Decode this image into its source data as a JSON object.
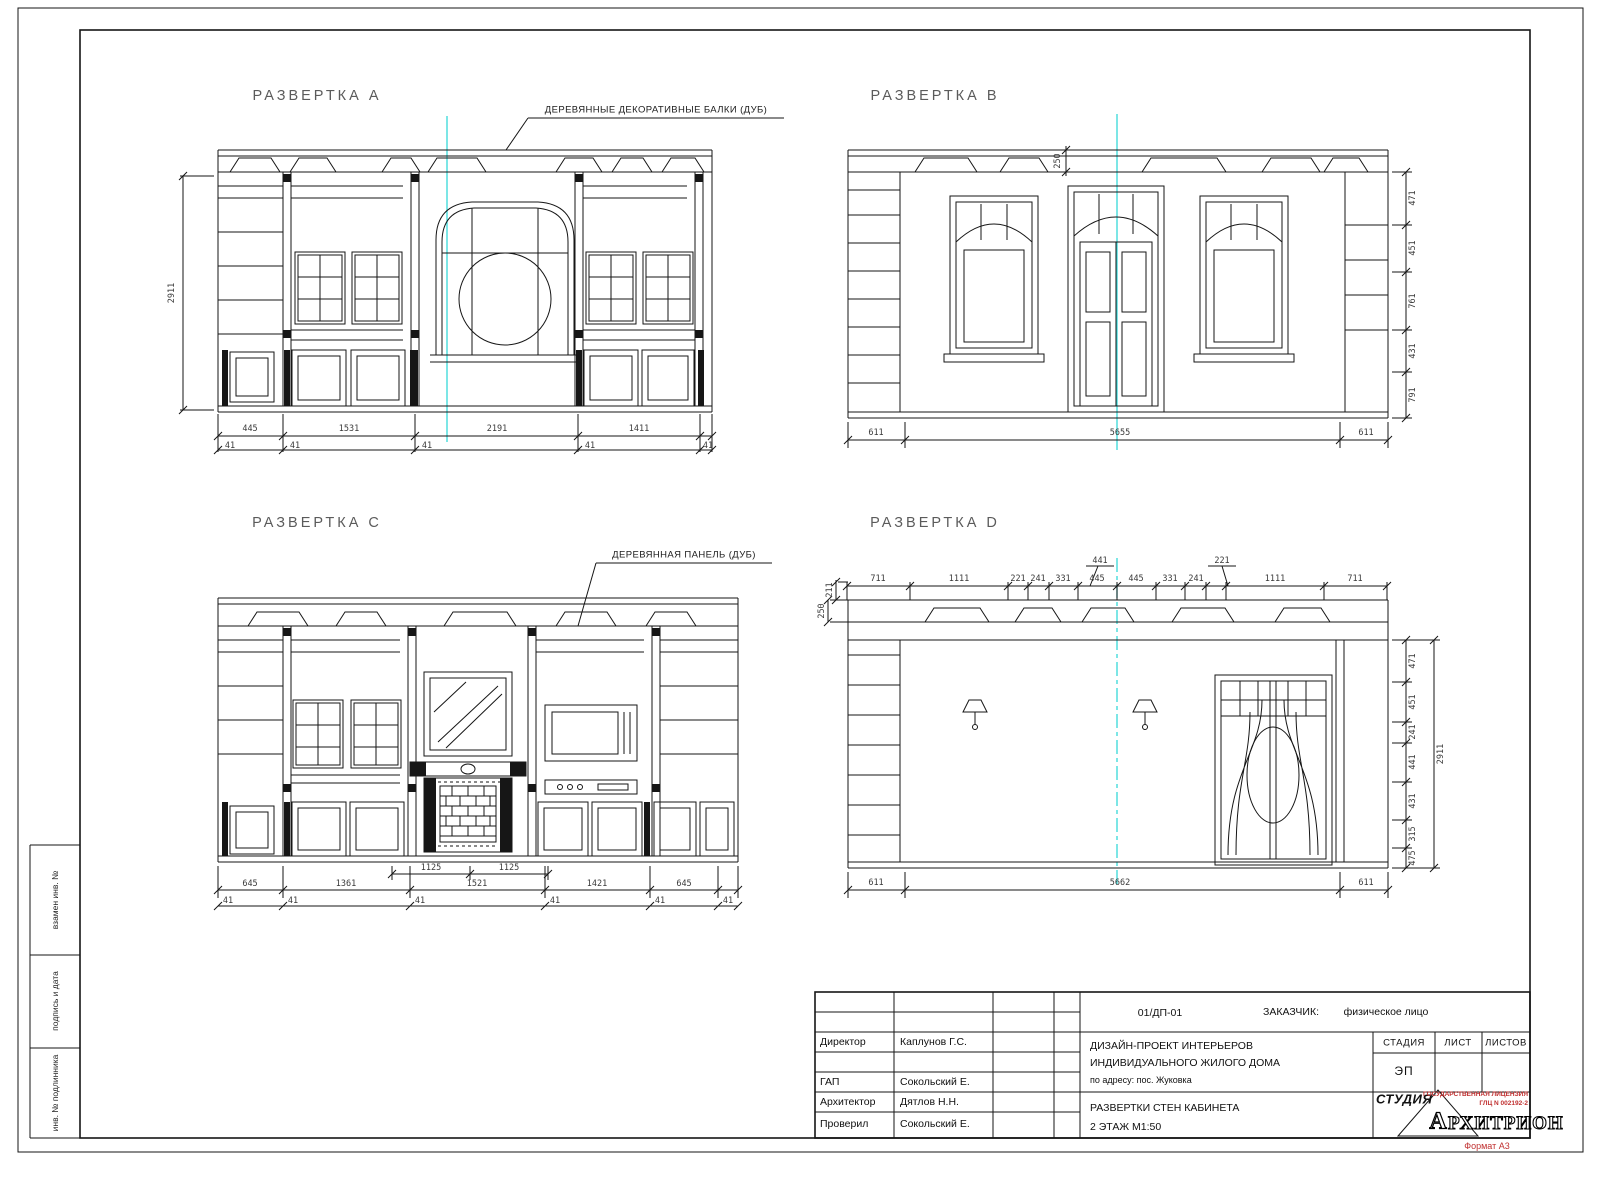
{
  "palette": {
    "ink": "#161616",
    "dim": "#3a3a3a",
    "title": "#5b5b5b",
    "cyan": "#35d8d8",
    "red": "#c03030"
  },
  "elevations": {
    "a": {
      "title": "РАЗВЕРТКА  A",
      "callout": "ДЕРЕВЯННЫЕ ДЕКОРАТИВНЫЕ БАЛКИ (ДУБ)"
    },
    "b": {
      "title": "РАЗВЕРТКА  B"
    },
    "c": {
      "title": "РАЗВЕРТКА  C",
      "callout": "ДЕРЕВЯННАЯ ПАНЕЛЬ (ДУБ)"
    },
    "d": {
      "title": "РАЗВЕРТКА  D"
    }
  },
  "dim_labels": {
    "a": [
      {
        "t": "2911",
        "x": 172,
        "y": 293,
        "r": -90
      },
      {
        "t": "445",
        "x": 250,
        "y": 429
      },
      {
        "t": "1531",
        "x": 349,
        "y": 429
      },
      {
        "t": "2191",
        "x": 497,
        "y": 429
      },
      {
        "t": "1411",
        "x": 639,
        "y": 429
      },
      {
        "t": "41",
        "x": 230,
        "y": 446
      },
      {
        "t": "41",
        "x": 295,
        "y": 446
      },
      {
        "t": "41",
        "x": 427,
        "y": 446
      },
      {
        "t": "41",
        "x": 590,
        "y": 446
      },
      {
        "t": "41",
        "x": 708,
        "y": 446
      }
    ],
    "b": [
      {
        "t": "250",
        "x": 1058,
        "y": 161,
        "r": -90
      },
      {
        "t": "471",
        "x": 1413,
        "y": 198,
        "r": -90
      },
      {
        "t": "451",
        "x": 1413,
        "y": 248,
        "r": -90
      },
      {
        "t": "761",
        "x": 1413,
        "y": 301,
        "r": -90
      },
      {
        "t": "431",
        "x": 1413,
        "y": 351,
        "r": -90
      },
      {
        "t": "791",
        "x": 1413,
        "y": 395,
        "r": -90
      },
      {
        "t": "611",
        "x": 876,
        "y": 433
      },
      {
        "t": "5655",
        "x": 1120,
        "y": 433
      },
      {
        "t": "611",
        "x": 1366,
        "y": 433
      }
    ],
    "c": [
      {
        "t": "1125",
        "x": 431,
        "y": 868
      },
      {
        "t": "1125",
        "x": 509,
        "y": 868
      },
      {
        "t": "645",
        "x": 250,
        "y": 884
      },
      {
        "t": "1361",
        "x": 346,
        "y": 884
      },
      {
        "t": "1521",
        "x": 477,
        "y": 884
      },
      {
        "t": "1421",
        "x": 597,
        "y": 884
      },
      {
        "t": "645",
        "x": 684,
        "y": 884
      },
      {
        "t": "41",
        "x": 228,
        "y": 901
      },
      {
        "t": "41",
        "x": 293,
        "y": 901
      },
      {
        "t": "41",
        "x": 420,
        "y": 901
      },
      {
        "t": "41",
        "x": 555,
        "y": 901
      },
      {
        "t": "41",
        "x": 660,
        "y": 901
      },
      {
        "t": "41",
        "x": 728,
        "y": 901
      }
    ],
    "d": [
      {
        "t": "211",
        "x": 830,
        "y": 590,
        "r": -90
      },
      {
        "t": "250",
        "x": 822,
        "y": 611,
        "r": -90
      },
      {
        "t": "711",
        "x": 878,
        "y": 579
      },
      {
        "t": "1111",
        "x": 959,
        "y": 579
      },
      {
        "t": "221",
        "x": 1018,
        "y": 579
      },
      {
        "t": "241",
        "x": 1038,
        "y": 579
      },
      {
        "t": "331",
        "x": 1063,
        "y": 579
      },
      {
        "t": "445",
        "x": 1097,
        "y": 579
      },
      {
        "t": "441",
        "x": 1100,
        "y": 561
      },
      {
        "t": "445",
        "x": 1136,
        "y": 579
      },
      {
        "t": "331",
        "x": 1170,
        "y": 579
      },
      {
        "t": "241",
        "x": 1196,
        "y": 579
      },
      {
        "t": "221",
        "x": 1222,
        "y": 561
      },
      {
        "t": "1111",
        "x": 1275,
        "y": 579
      },
      {
        "t": "711",
        "x": 1355,
        "y": 579
      },
      {
        "t": "471",
        "x": 1413,
        "y": 661,
        "r": -90
      },
      {
        "t": "451",
        "x": 1413,
        "y": 702,
        "r": -90
      },
      {
        "t": "241",
        "x": 1413,
        "y": 732,
        "r": -90
      },
      {
        "t": "441",
        "x": 1413,
        "y": 762,
        "r": -90
      },
      {
        "t": "431",
        "x": 1413,
        "y": 801,
        "r": -90
      },
      {
        "t": "315",
        "x": 1413,
        "y": 834,
        "r": -90
      },
      {
        "t": "475",
        "x": 1413,
        "y": 858,
        "r": -90
      },
      {
        "t": "2911",
        "x": 1441,
        "y": 754,
        "r": -90
      },
      {
        "t": "611",
        "x": 876,
        "y": 883
      },
      {
        "t": "5662",
        "x": 1120,
        "y": 883
      },
      {
        "t": "611",
        "x": 1366,
        "y": 883
      }
    ]
  },
  "margin_labels": [
    "взамен инв. №",
    "подпись и дата",
    "инв. № подлинника"
  ],
  "titleblock": {
    "doc_number": "01/ДП-01",
    "customer_label": "ЗАКАЗЧИК:",
    "customer_value": "физическое лицо",
    "roles": [
      {
        "role": "Директор",
        "name": "Каплунов Г.С."
      },
      {
        "role": "ГАП",
        "name": "Сокольский Е."
      },
      {
        "role": "Архитектор",
        "name": "Дятлов Н.Н."
      },
      {
        "role": "Проверил",
        "name": "Сокольский Е."
      }
    ],
    "project_line1": "ДИЗАЙН-ПРОЕКТ ИНТЕРЬЕРОВ",
    "project_line2": "ИНДИВИДУАЛЬНОГО ЖИЛОГО ДОМА",
    "project_line3": "по адресу: пос. Жуковка",
    "sheet_title_line1": "РАЗВЕРТКИ СТЕН КАБИНЕТА",
    "sheet_title_line2": "2 ЭТАЖ    М1:50",
    "stage_label": "СТАДИЯ",
    "sheet_label": "ЛИСТ",
    "sheets_label": "ЛИСТОВ",
    "stage_value": "ЭП",
    "studio_label": "СТУДИЯ",
    "logo_letter": "А",
    "logo_text": "РХИТРИОН",
    "license_line1": "ГОСУДАРСТВЕННАЯ ЛИЦЕНЗИЯ",
    "license_line2": "ГЛЦ N 002192-2",
    "format_label": "Формат А3"
  }
}
